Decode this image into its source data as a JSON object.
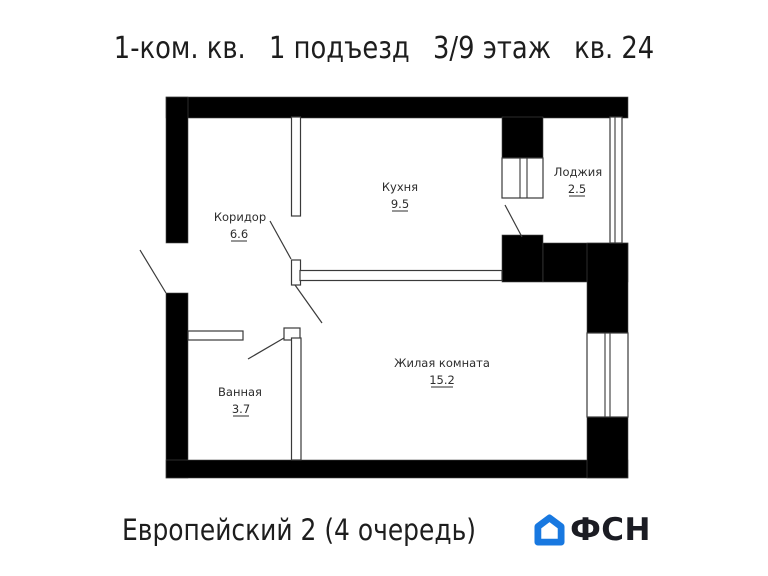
{
  "header": {
    "parts": [
      "1-ком. кв.",
      "1 подъезд",
      "3/9 этаж",
      "кв. 24"
    ]
  },
  "plan": {
    "rooms": [
      {
        "name": "Кухня",
        "area": "9.5"
      },
      {
        "name": "Коридор",
        "area": "6.6"
      },
      {
        "name": "Лоджия",
        "area": "2.5"
      },
      {
        "name": "Жилая комната",
        "area": "15.2"
      },
      {
        "name": "Ванная",
        "area": "3.7"
      }
    ]
  },
  "footer": {
    "project": "Европейский 2 (4 очередь)",
    "logo_text": "ФСН"
  },
  "colors": {
    "wall": "#000000",
    "thin_line": "#3a3a3a",
    "logo_blue": "#1878e0",
    "logo_text_color": "#1b1c23"
  }
}
